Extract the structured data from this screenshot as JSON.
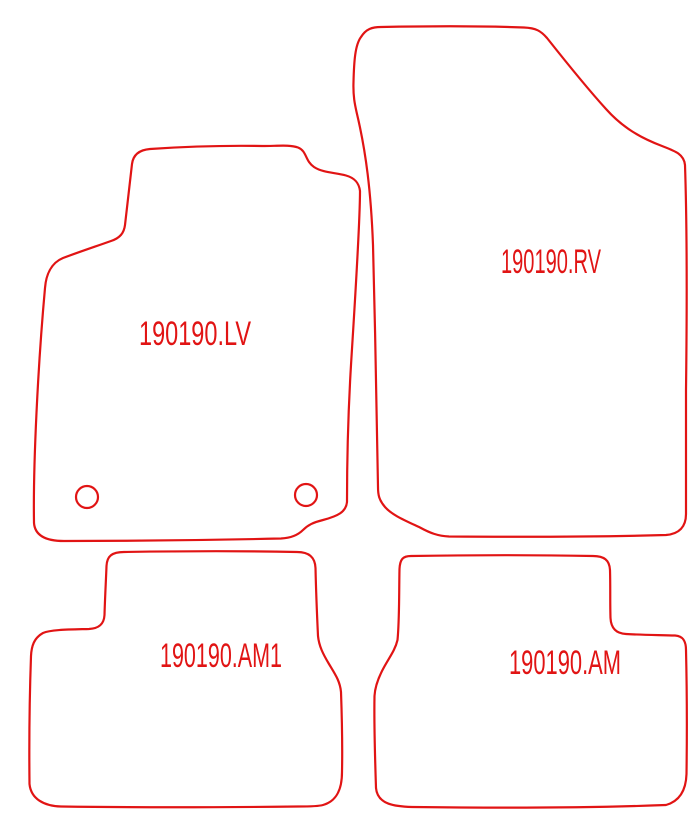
{
  "page": {
    "background_color": "#ffffff",
    "outline_color": "#e11414",
    "type_label": "car floor mat cutting diagram"
  },
  "mats": [
    {
      "id": "front-left",
      "label": "190190.LV",
      "holes": 2
    },
    {
      "id": "front-right",
      "label": "190190.RV",
      "holes": 0
    },
    {
      "id": "rear-left",
      "label": "190190.AM1",
      "holes": 0
    },
    {
      "id": "rear-right",
      "label": "190190.AM",
      "holes": 0
    }
  ]
}
